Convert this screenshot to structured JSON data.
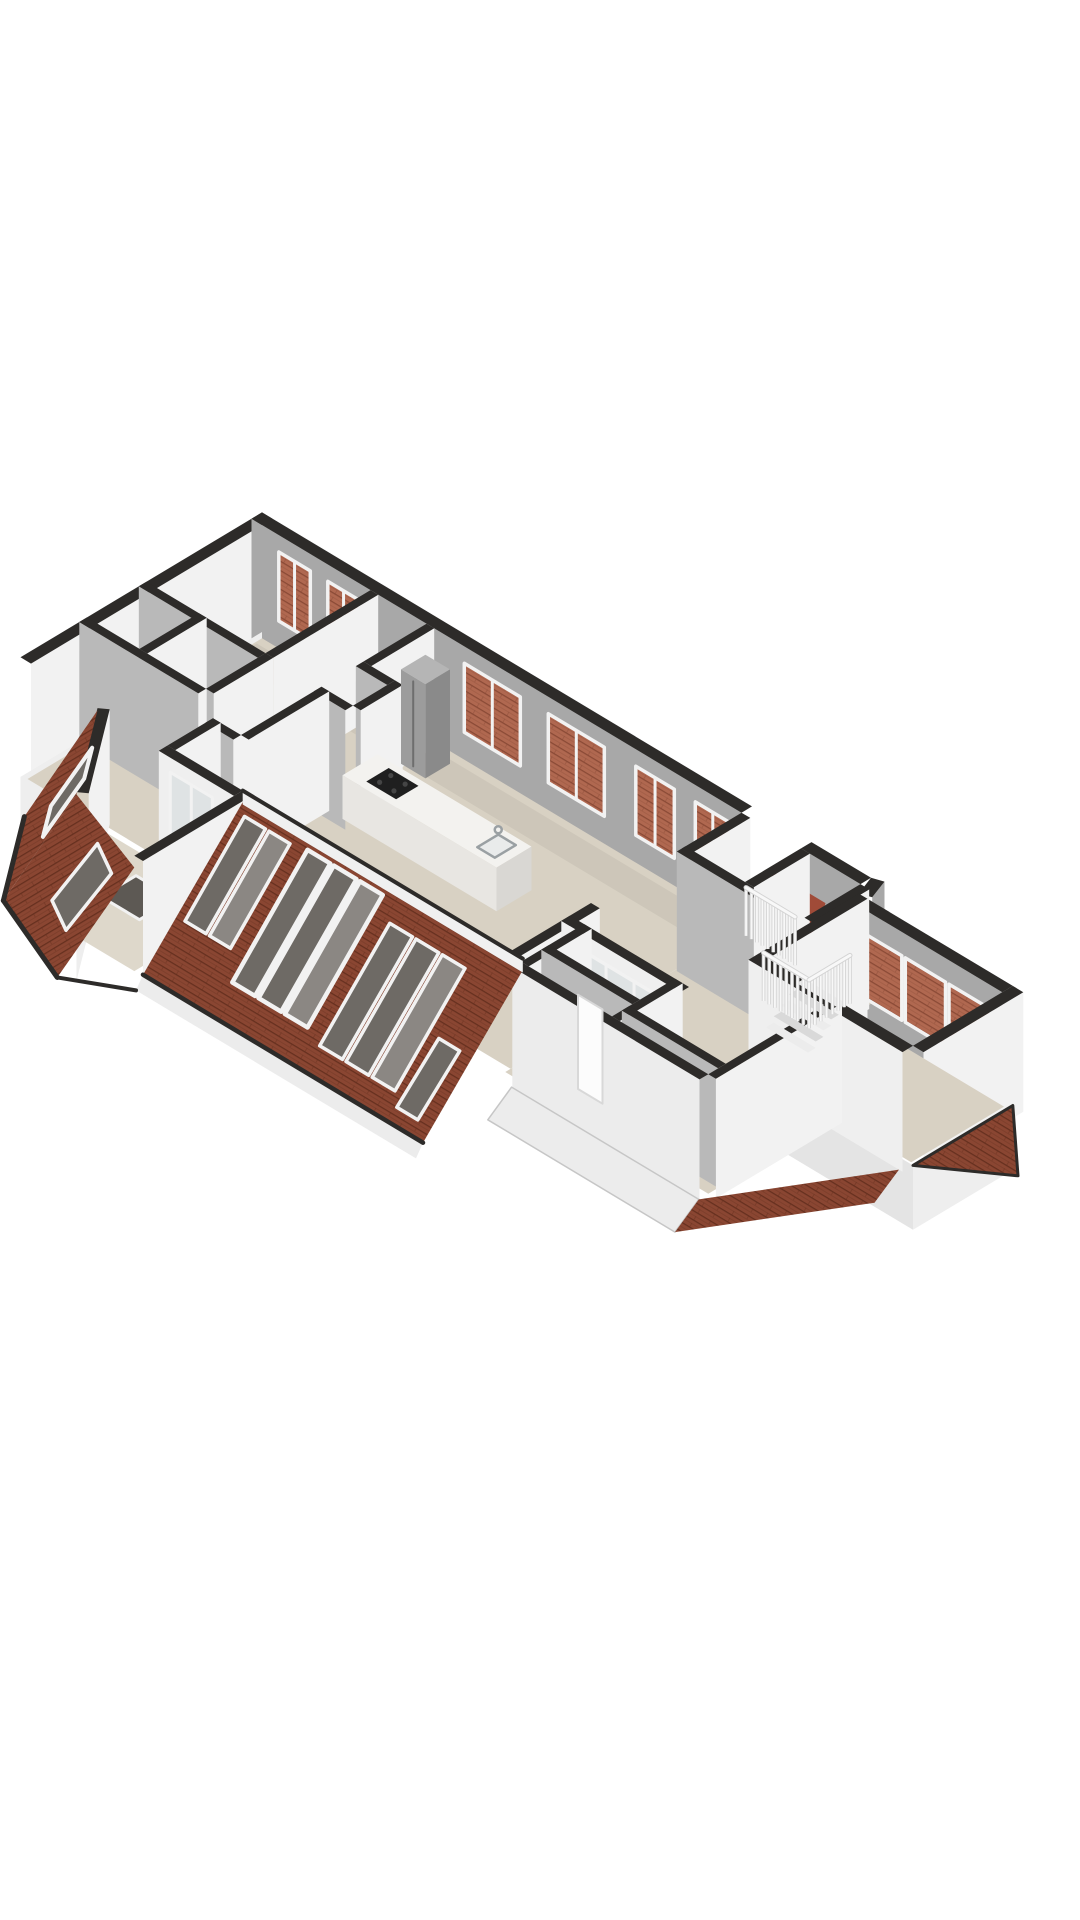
{
  "meta": {
    "title": "3D floor plan render",
    "aria_label": "Isometric 3D floor plan of an attic storey with open living area, kitchen island, sloped tiled roof with roof windows, terrace, balcony and stairwell"
  },
  "palette": {
    "bg": "#ffffff",
    "floor": "#d8d1c3",
    "floorLight": "#ded8cb",
    "floorShadow": "rgba(0,0,0,0.05)",
    "floorVoid": "#5d5954",
    "wallWhite": "#f2f2f2",
    "wallLight": "#fafafa",
    "wallSun": "#efefef",
    "wallGrayFace": "#a8a8a8",
    "wallGray": "#b9b9b9",
    "skirtWhite": "#eeeeee",
    "skirtGray": "#bdbdbd",
    "skirtMid": "#e4e4e4",
    "cap": "#2d2b29",
    "roofBase": "#8a4632",
    "roofLine": "#66301f",
    "roofThruBase": "#b06850",
    "roofThruLine": "#8a4a36",
    "eave": "#ececec",
    "eaveEdge": "#c6c6c6",
    "glassDark": "#6e6a65",
    "glassMid": "#8b8783",
    "glassPale": "#dfe3e4",
    "frame": "#f2f2f2",
    "brick": "#a04b38",
    "islandTop": "#f3f2ef",
    "islandSide": "#e8e6e2",
    "islandFront": "#d9d7d3",
    "cooktop": "#1f1f1f",
    "burner": "#454545",
    "steel": "#9c9c9c",
    "steelTop": "#b5b5b5",
    "steelDark": "#8a8a8a",
    "steelEdge": "#6e6e6e",
    "railLight": "#f8f8f8",
    "railShadow": "#d4d4d4",
    "stepLight": "#ececec",
    "stepDark": "#d9d9d9",
    "sink": "#e9ebeb",
    "sinkEdge": "#9aa0a3",
    "doorLeaf": "#fcfcfc",
    "doorEdge": "#d8d8d8"
  },
  "features": [
    "attic-floor-plan",
    "living-room",
    "kitchen-island",
    "cooktop",
    "sink",
    "fridge",
    "hallway",
    "bedroom",
    "bathroom",
    "terrace",
    "terrace-glass-floor",
    "sloped-roof",
    "roof-windows",
    "balcony",
    "balustrade",
    "stairwell",
    "stairs",
    "windows-with-roof-view",
    "eaves"
  ]
}
